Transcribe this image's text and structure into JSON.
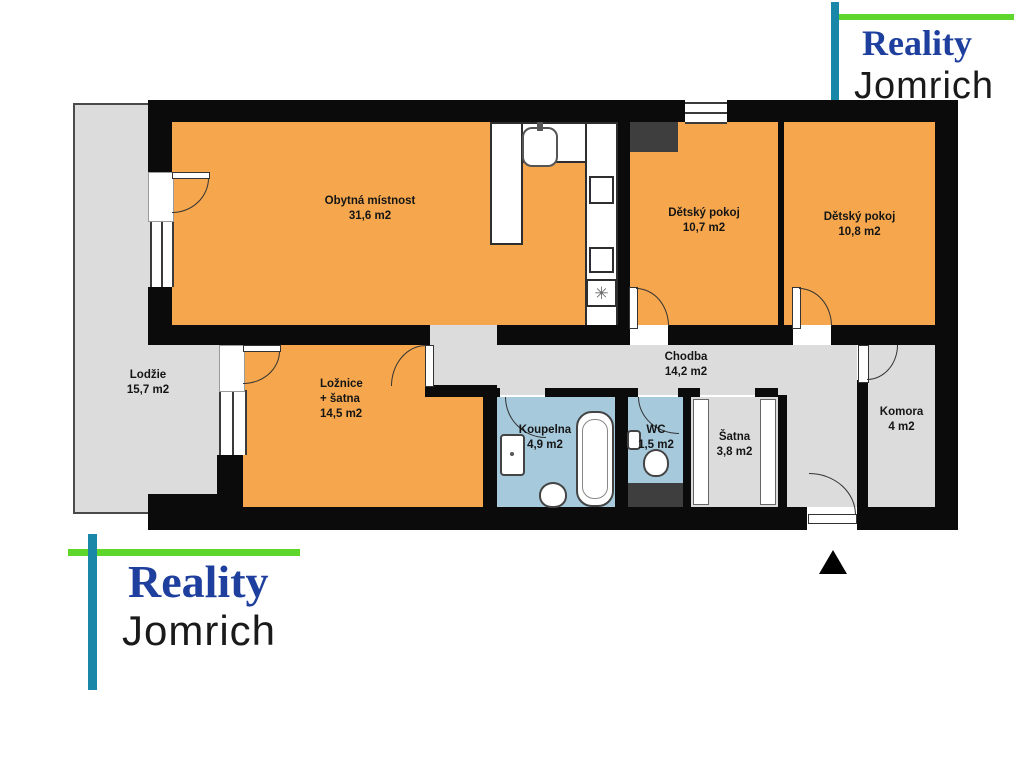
{
  "brand": {
    "line1": "Reality",
    "line2": "Jomrich"
  },
  "colors": {
    "room_orange": "#F6A74D",
    "room_gray": "#DCDCDC",
    "bath_blue": "#A6C9DC",
    "wall_black": "#0B0B0B",
    "shaft_dark_gray": "#3E3E3E",
    "logo_green": "#5FD62C",
    "logo_teal": "#1987A8",
    "logo_reality_blue": "#1F3F9E",
    "logo_jomrich_black": "#1A1A1A"
  },
  "rooms": [
    {
      "id": "living",
      "name": "Obytná místnost",
      "area": "31,6 m2"
    },
    {
      "id": "child1",
      "name": "Dětský pokoj",
      "area": "10,7 m2"
    },
    {
      "id": "child2",
      "name": "Dětský pokoj",
      "area": "10,8 m2"
    },
    {
      "id": "loggia",
      "name": "Lodžie",
      "area": "15,7 m2"
    },
    {
      "id": "bedroom",
      "name": "Ložnice",
      "name2": "+ šatna",
      "area": "14,5 m2"
    },
    {
      "id": "hall",
      "name": "Chodba",
      "area": "14,2 m2"
    },
    {
      "id": "bath",
      "name": "Koupelna",
      "area": "4,9 m2"
    },
    {
      "id": "wc",
      "name": "WC",
      "area": "1,5 m2"
    },
    {
      "id": "satna",
      "name": "Šatna",
      "area": "3,8 m2"
    },
    {
      "id": "komora",
      "name": "Komora",
      "area": "4 m2"
    }
  ],
  "icons": {
    "hob_glyph": "✳"
  }
}
